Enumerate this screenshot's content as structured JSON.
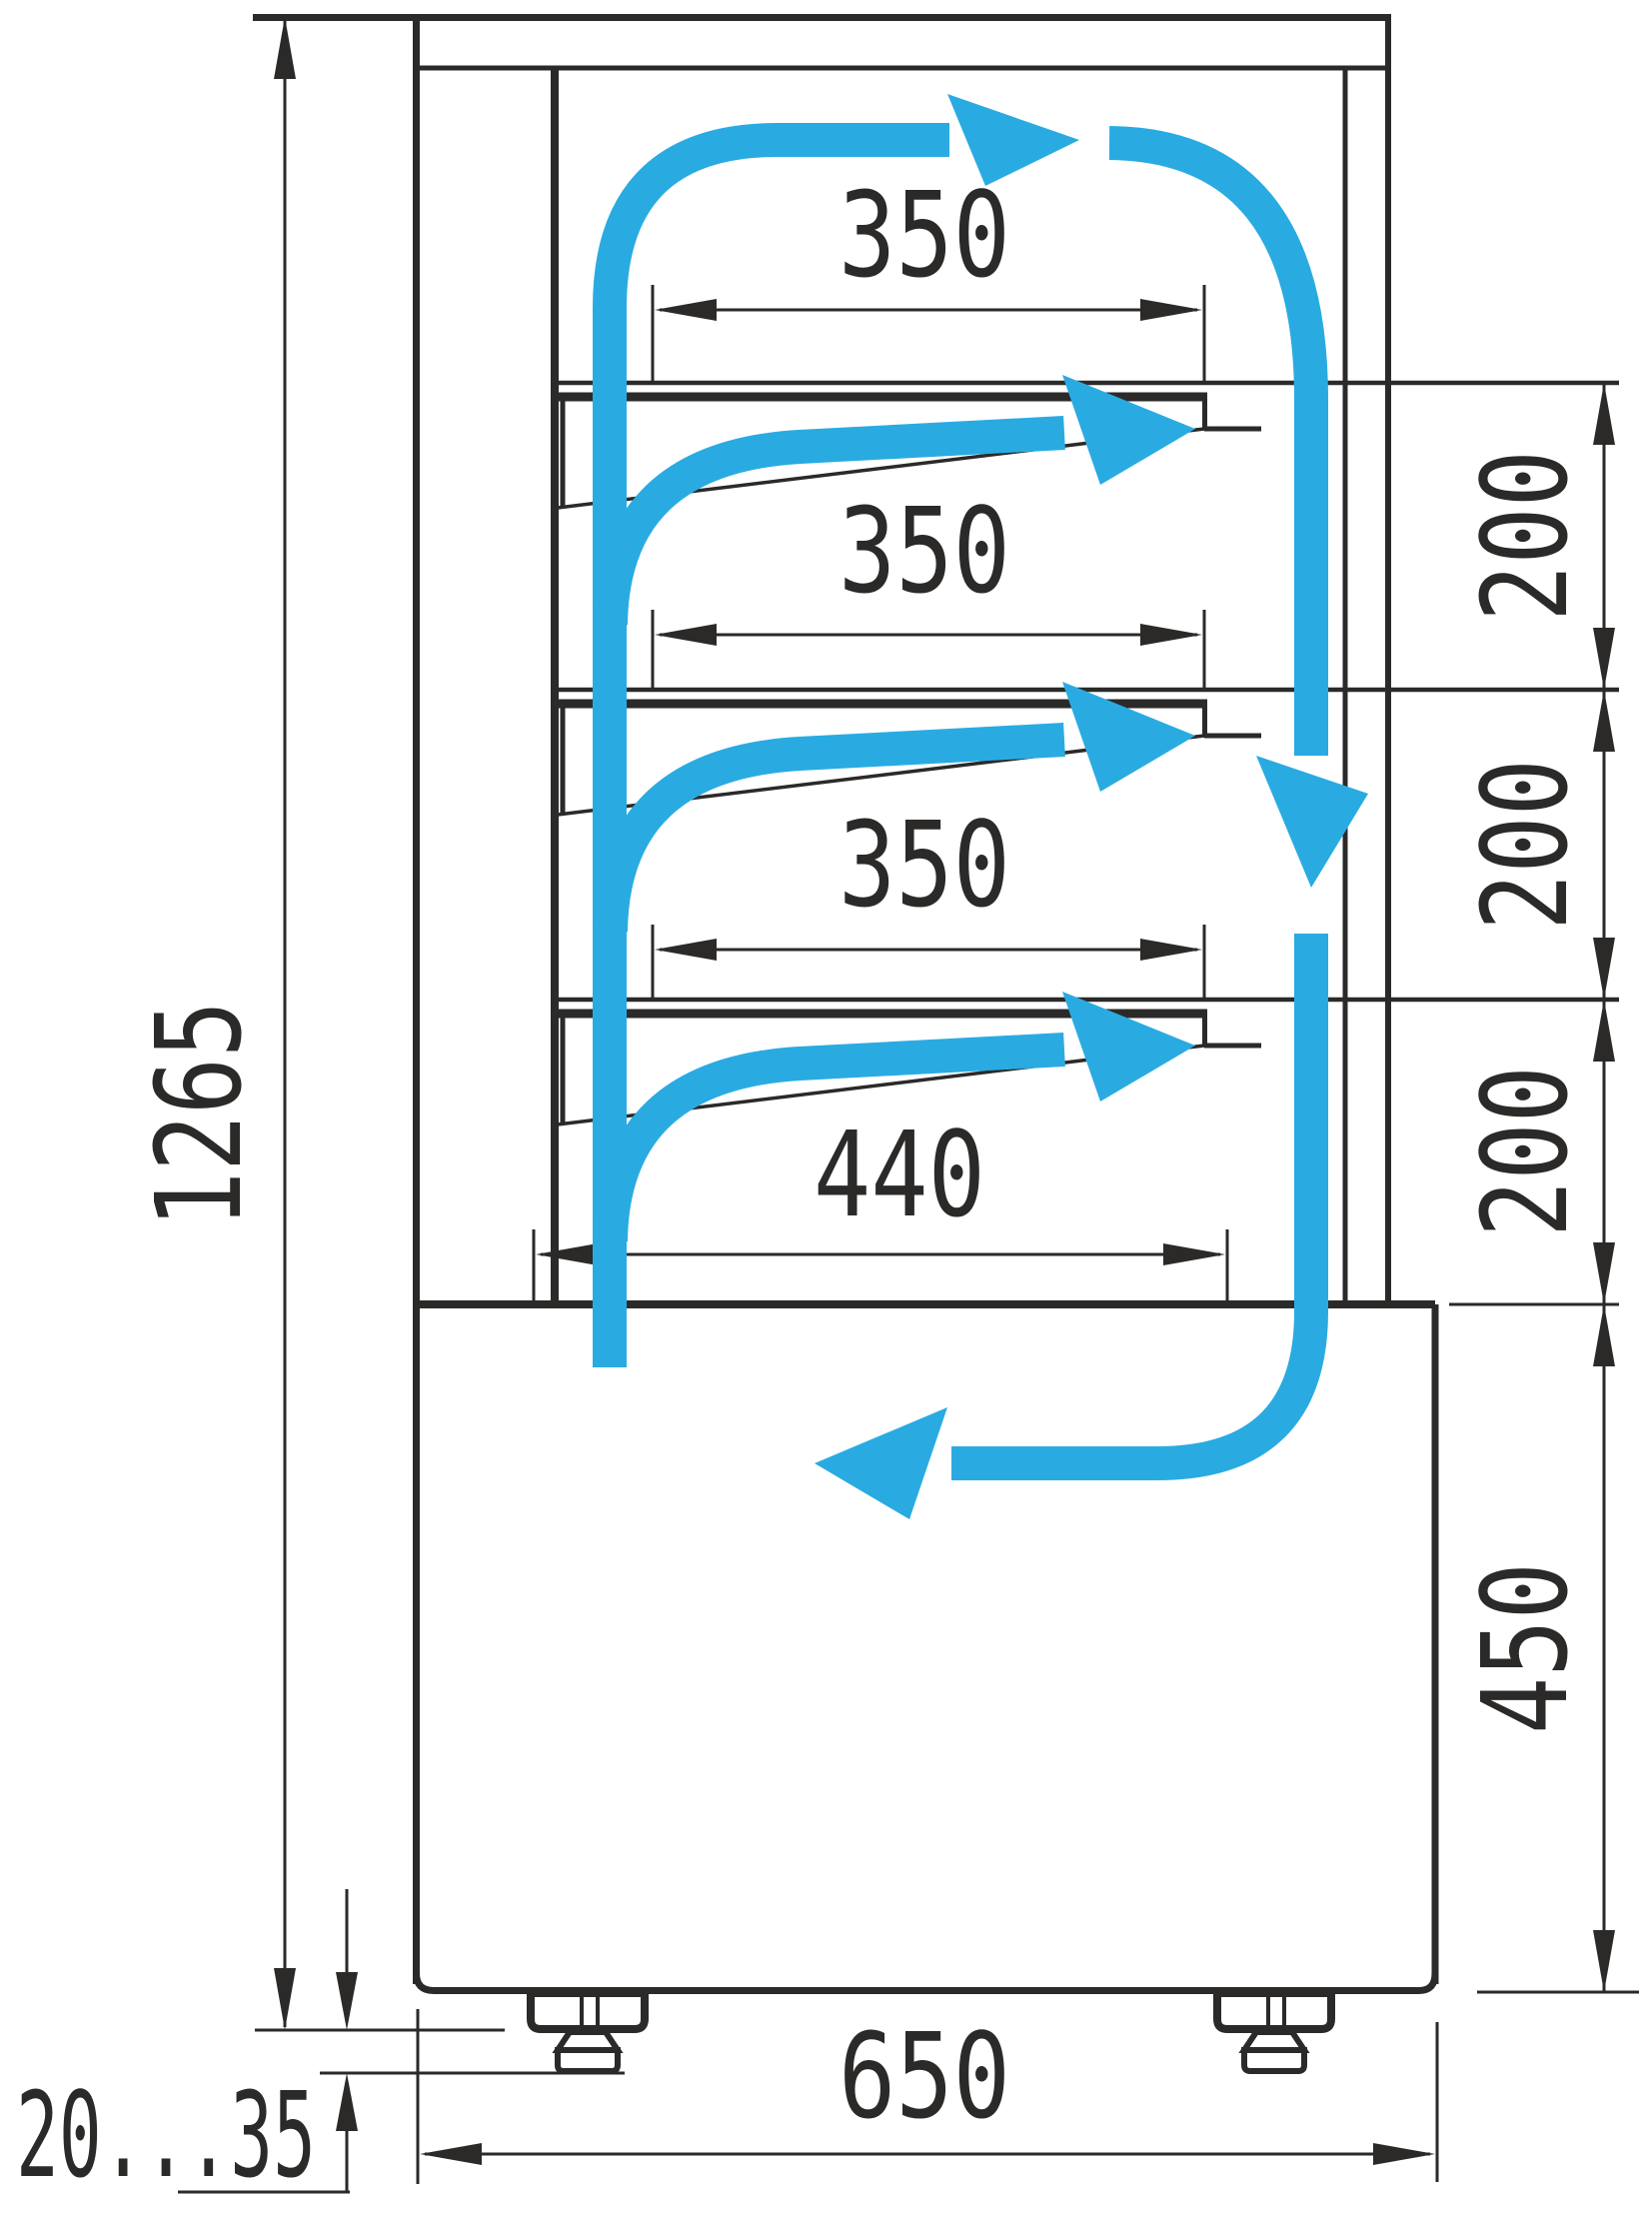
{
  "diagram": {
    "type": "technical-drawing",
    "subject": "refrigerated pastry display case side cross-section with air circulation",
    "shelf_depths": [
      "350",
      "350",
      "350"
    ],
    "bottom_shelf_depth": "440",
    "shelf_spacings": [
      "200",
      "200",
      "200"
    ],
    "base_height": "450",
    "overall_height": "1265",
    "overall_depth": "650",
    "foot_adjust_range": "20...35",
    "colors": {
      "ink": "#2b2a29",
      "airflow": "#29abe2",
      "background": "#ffffff"
    }
  }
}
